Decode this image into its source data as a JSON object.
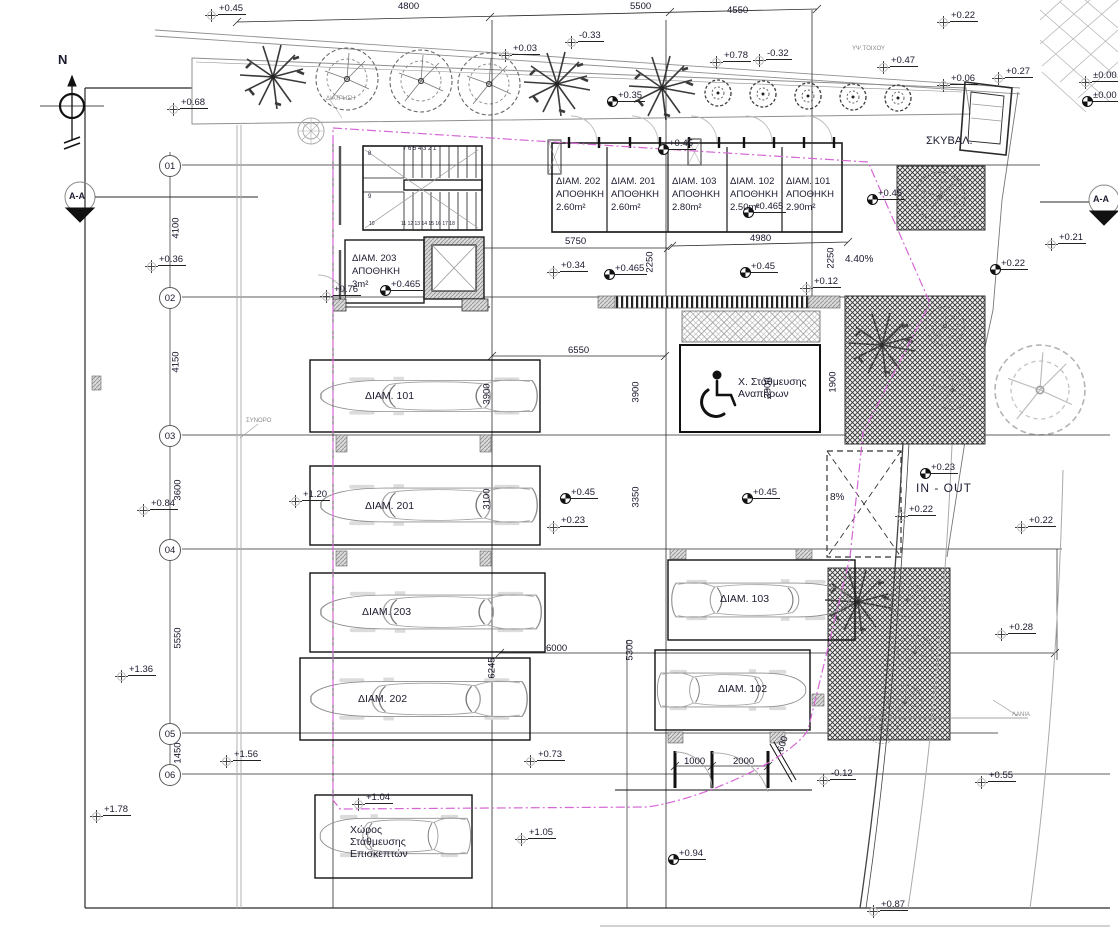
{
  "drawing_type": "site-plan",
  "colors": {
    "line": "#2a2a2a",
    "boundary_magenta": "#d566d5",
    "grey": "#9a9a9a",
    "text": "#1b1b2f"
  },
  "north_label": "N",
  "section_marker": "A-A",
  "grid_bubbles": [
    {
      "label": "01",
      "y": 165
    },
    {
      "label": "02",
      "y": 297
    },
    {
      "label": "03",
      "y": 435
    },
    {
      "label": "04",
      "y": 549
    },
    {
      "label": "05",
      "y": 733
    },
    {
      "label": "06",
      "y": 774
    }
  ],
  "storage_units": [
    {
      "name": "ΔΙΑΜ. 202",
      "type": "ΑΠΟΘΗΚΗ",
      "area": "2.60m²",
      "x": 556
    },
    {
      "name": "ΔΙΑΜ. 201",
      "type": "ΑΠΟΘΗΚΗ",
      "area": "2.60m²",
      "x": 611
    },
    {
      "name": "ΔΙΑΜ. 103",
      "type": "ΑΠΟΘΗΚΗ",
      "area": "2.80m²",
      "x": 672
    },
    {
      "name": "ΔΙΑΜ. 102",
      "type": "ΑΠΟΘΗΚΗ",
      "area": "2.50m²",
      "x": 730
    },
    {
      "name": "ΔΙΑΜ. 101",
      "type": "ΑΠΟΘΗΚΗ",
      "area": "2.90m²",
      "x": 786
    }
  ],
  "storage_203": {
    "name": "ΔΙΑΜ. 203",
    "type": "ΑΠΟΘΗΚΗ",
    "area": "3m²",
    "x": 352,
    "y": 253
  },
  "parking_labels": [
    {
      "t": "ΔΙΑΜ. 101",
      "x": 365,
      "y": 390
    },
    {
      "t": "ΔΙΑΜ. 201",
      "x": 365,
      "y": 500
    },
    {
      "t": "ΔΙΑΜ. 203",
      "x": 362,
      "y": 606
    },
    {
      "t": "ΔΙΑΜ. 202",
      "x": 358,
      "y": 693
    },
    {
      "t": "ΔΙΑΜ. 103",
      "x": 720,
      "y": 593
    },
    {
      "t": "ΔΙΑΜ. 102",
      "x": 718,
      "y": 683
    }
  ],
  "disabled_parking": {
    "line1": "Χ. Στάθμευσης",
    "line2": "Αναπήρων",
    "x": 738,
    "y": 376
  },
  "visitor_parking": {
    "lines": "Χώρος\nΣτάθμευσης\nΕπισκεπτών",
    "x": 350,
    "y": 824
  },
  "texts": [
    {
      "t": "N",
      "x": 58,
      "y": 52,
      "c": "t13b"
    },
    {
      "t": "A-A",
      "x": 69,
      "y": 191,
      "c": "t9b"
    },
    {
      "t": "A-A",
      "x": 1093,
      "y": 194,
      "c": "t9b"
    },
    {
      "t": "IN - OUT",
      "x": 916,
      "y": 481,
      "c": "inout"
    },
    {
      "t": "8%",
      "x": 830,
      "y": 492,
      "c": ""
    },
    {
      "t": "4.40%",
      "x": 845,
      "y": 254,
      "c": ""
    },
    {
      "t": "ΣΚΥΒΑΛ.",
      "x": 926,
      "y": 135,
      "c": "t11"
    },
    {
      "t": "ΥΨ.ΤΟΙΧΟΥ",
      "x": 852,
      "y": 46,
      "c": "tiny"
    },
    {
      "t": "ΔΙΑΤΡΗΣΗ",
      "x": 326,
      "y": 96,
      "c": "tiny"
    },
    {
      "t": "ΣΥΝΟΡΟ",
      "x": 246,
      "y": 418,
      "c": "tiny"
    },
    {
      "t": "ΛΑΝΙΑ",
      "x": 1012,
      "y": 712,
      "c": "tiny"
    },
    {
      "t": "7 6 5 4 3 2 1",
      "x": 403,
      "y": 146,
      "c": "stair1"
    },
    {
      "t": "8",
      "x": 368,
      "y": 151,
      "c": "stair1"
    },
    {
      "t": "9",
      "x": 368,
      "y": 194,
      "c": "stair1"
    },
    {
      "t": "10",
      "x": 369,
      "y": 221,
      "c": "stair2"
    },
    {
      "t": "11 12 13 14 15 16 17 18",
      "x": 401,
      "y": 221,
      "c": "stair2"
    }
  ],
  "dims_h": [
    {
      "t": "4800",
      "x": 398,
      "y": 1
    },
    {
      "t": "5500",
      "x": 630,
      "y": 1
    },
    {
      "t": "4550",
      "x": 727,
      "y": 5
    },
    {
      "t": "5750",
      "x": 565,
      "y": 236
    },
    {
      "t": "4980",
      "x": 750,
      "y": 233
    },
    {
      "t": "6550",
      "x": 568,
      "y": 345
    },
    {
      "t": "6000",
      "x": 546,
      "y": 643
    },
    {
      "t": "1000",
      "x": 684,
      "y": 756
    },
    {
      "t": "2000",
      "x": 733,
      "y": 756
    }
  ],
  "dims_v": [
    {
      "t": "4100",
      "x": 176,
      "y": 228
    },
    {
      "t": "4150",
      "x": 176,
      "y": 362
    },
    {
      "t": "3600",
      "x": 178,
      "y": 490
    },
    {
      "t": "5550",
      "x": 178,
      "y": 638
    },
    {
      "t": "1450",
      "x": 178,
      "y": 753
    },
    {
      "t": "2250",
      "x": 650,
      "y": 262
    },
    {
      "t": "2250",
      "x": 831,
      "y": 258
    },
    {
      "t": "3900",
      "x": 487,
      "y": 394
    },
    {
      "t": "3900",
      "x": 636,
      "y": 392
    },
    {
      "t": "3900",
      "x": 768,
      "y": 388
    },
    {
      "t": "1900",
      "x": 833,
      "y": 382
    },
    {
      "t": "3100",
      "x": 487,
      "y": 499
    },
    {
      "t": "3350",
      "x": 636,
      "y": 497
    },
    {
      "t": "6245",
      "x": 492,
      "y": 668
    },
    {
      "t": "5300",
      "x": 630,
      "y": 650
    },
    {
      "t": "600",
      "x": 783,
      "y": 744,
      "c": "dimv2"
    }
  ],
  "elevations": [
    {
      "t": "+0.45",
      "x": 218,
      "y": 3,
      "s": "c"
    },
    {
      "t": "+0.68",
      "x": 180,
      "y": 97,
      "s": "c"
    },
    {
      "t": "+0.03",
      "x": 512,
      "y": 43,
      "s": "c"
    },
    {
      "t": "+0.78",
      "x": 723,
      "y": 50,
      "s": "c"
    },
    {
      "t": "-0.33",
      "x": 578,
      "y": 30,
      "s": "c"
    },
    {
      "t": "-0.32",
      "x": 766,
      "y": 48,
      "s": "c"
    },
    {
      "t": "+0.47",
      "x": 890,
      "y": 55,
      "s": "c"
    },
    {
      "t": "+0.22",
      "x": 950,
      "y": 10,
      "s": "c"
    },
    {
      "t": "+0.06",
      "x": 950,
      "y": 73,
      "s": "c"
    },
    {
      "t": "+0.27",
      "x": 1005,
      "y": 66,
      "s": "c"
    },
    {
      "t": "±0.00",
      "x": 1092,
      "y": 70,
      "s": "c"
    },
    {
      "t": "±0.00",
      "x": 1092,
      "y": 90,
      "s": "b"
    },
    {
      "t": "+0.35",
      "x": 617,
      "y": 90,
      "s": "b"
    },
    {
      "t": "+0.36",
      "x": 158,
      "y": 254,
      "s": "c"
    },
    {
      "t": "+0.84",
      "x": 150,
      "y": 498,
      "s": "c"
    },
    {
      "t": "+1.36",
      "x": 128,
      "y": 664,
      "s": "c"
    },
    {
      "t": "+1.56",
      "x": 233,
      "y": 749,
      "s": "c"
    },
    {
      "t": "+1.78",
      "x": 103,
      "y": 804,
      "s": "c"
    },
    {
      "t": "+0.76",
      "x": 333,
      "y": 284,
      "s": "c"
    },
    {
      "t": "+0.45",
      "x": 668,
      "y": 138,
      "s": "b"
    },
    {
      "t": "+0.465",
      "x": 753,
      "y": 201,
      "s": "b"
    },
    {
      "t": "+0.34",
      "x": 560,
      "y": 260,
      "s": "c"
    },
    {
      "t": "+0.465",
      "x": 614,
      "y": 263,
      "s": "b"
    },
    {
      "t": "+0.465",
      "x": 390,
      "y": 279,
      "s": "b"
    },
    {
      "t": "+0.45",
      "x": 750,
      "y": 261,
      "s": "b"
    },
    {
      "t": "+0.12",
      "x": 813,
      "y": 276,
      "s": "c"
    },
    {
      "t": "+0.45",
      "x": 877,
      "y": 188,
      "s": "b"
    },
    {
      "t": "+0.21",
      "x": 1058,
      "y": 232,
      "s": "c"
    },
    {
      "t": "+0.22",
      "x": 1000,
      "y": 258,
      "s": "b"
    },
    {
      "t": "+0.45",
      "x": 570,
      "y": 487,
      "s": "b"
    },
    {
      "t": "+0.23",
      "x": 560,
      "y": 515,
      "s": "c"
    },
    {
      "t": "+0.45",
      "x": 752,
      "y": 487,
      "s": "b"
    },
    {
      "t": "+1.20",
      "x": 302,
      "y": 489,
      "s": "c"
    },
    {
      "t": "+0.23",
      "x": 930,
      "y": 462,
      "s": "b"
    },
    {
      "t": "+0.22",
      "x": 908,
      "y": 504,
      "s": "c"
    },
    {
      "t": "+0.22",
      "x": 1028,
      "y": 515,
      "s": "c"
    },
    {
      "t": "+0.73",
      "x": 537,
      "y": 749,
      "s": "c"
    },
    {
      "t": "-0.12",
      "x": 830,
      "y": 768,
      "s": "c"
    },
    {
      "t": "+1.04",
      "x": 365,
      "y": 792,
      "s": "c"
    },
    {
      "t": "+1.05",
      "x": 528,
      "y": 827,
      "s": "c"
    },
    {
      "t": "+0.94",
      "x": 678,
      "y": 848,
      "s": "b"
    },
    {
      "t": "+0.28",
      "x": 1008,
      "y": 622,
      "s": "c"
    },
    {
      "t": "+0.55",
      "x": 988,
      "y": 770,
      "s": "c"
    },
    {
      "t": "+0.87",
      "x": 880,
      "y": 899,
      "s": "c"
    }
  ]
}
